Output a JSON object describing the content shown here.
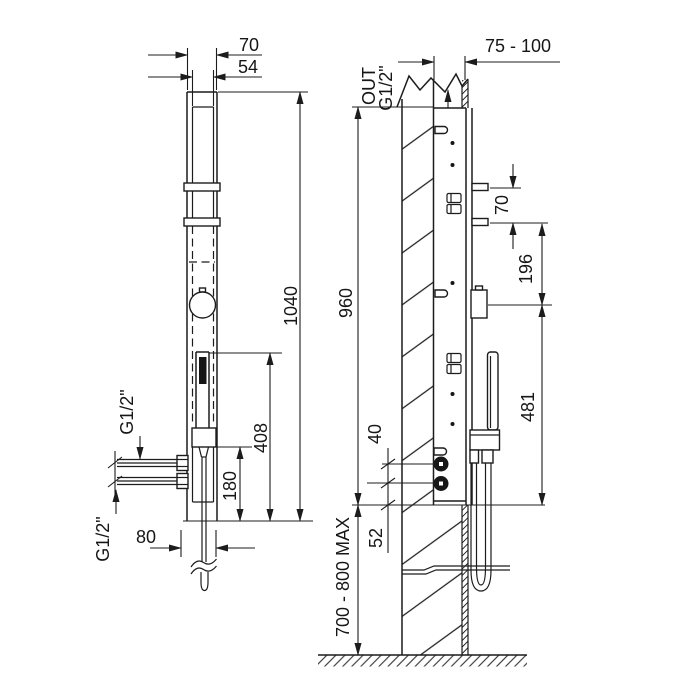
{
  "colors": {
    "line": "#1c1c1c",
    "background": "#ffffff"
  },
  "left_view": {
    "width_outer": "70",
    "width_inner": "54",
    "height_total": "1040",
    "handshower_height": "408",
    "outlet_height": "180",
    "depth": "80",
    "inlet_top_thread": "G1/2\"",
    "inlet_bottom_thread": "G1/2\""
  },
  "right_view": {
    "wall_distance": "75 - 100",
    "outlet_word": "OUT",
    "outlet_thread": "G1/2\"",
    "recess_height": "960",
    "bracket_spacing": "70",
    "bracket_to_outlet": "196",
    "handshower_height": "481",
    "knob_spacing": "40",
    "knob_to_bottom": "52",
    "floor_clearance": "700 - 800 MAX"
  }
}
